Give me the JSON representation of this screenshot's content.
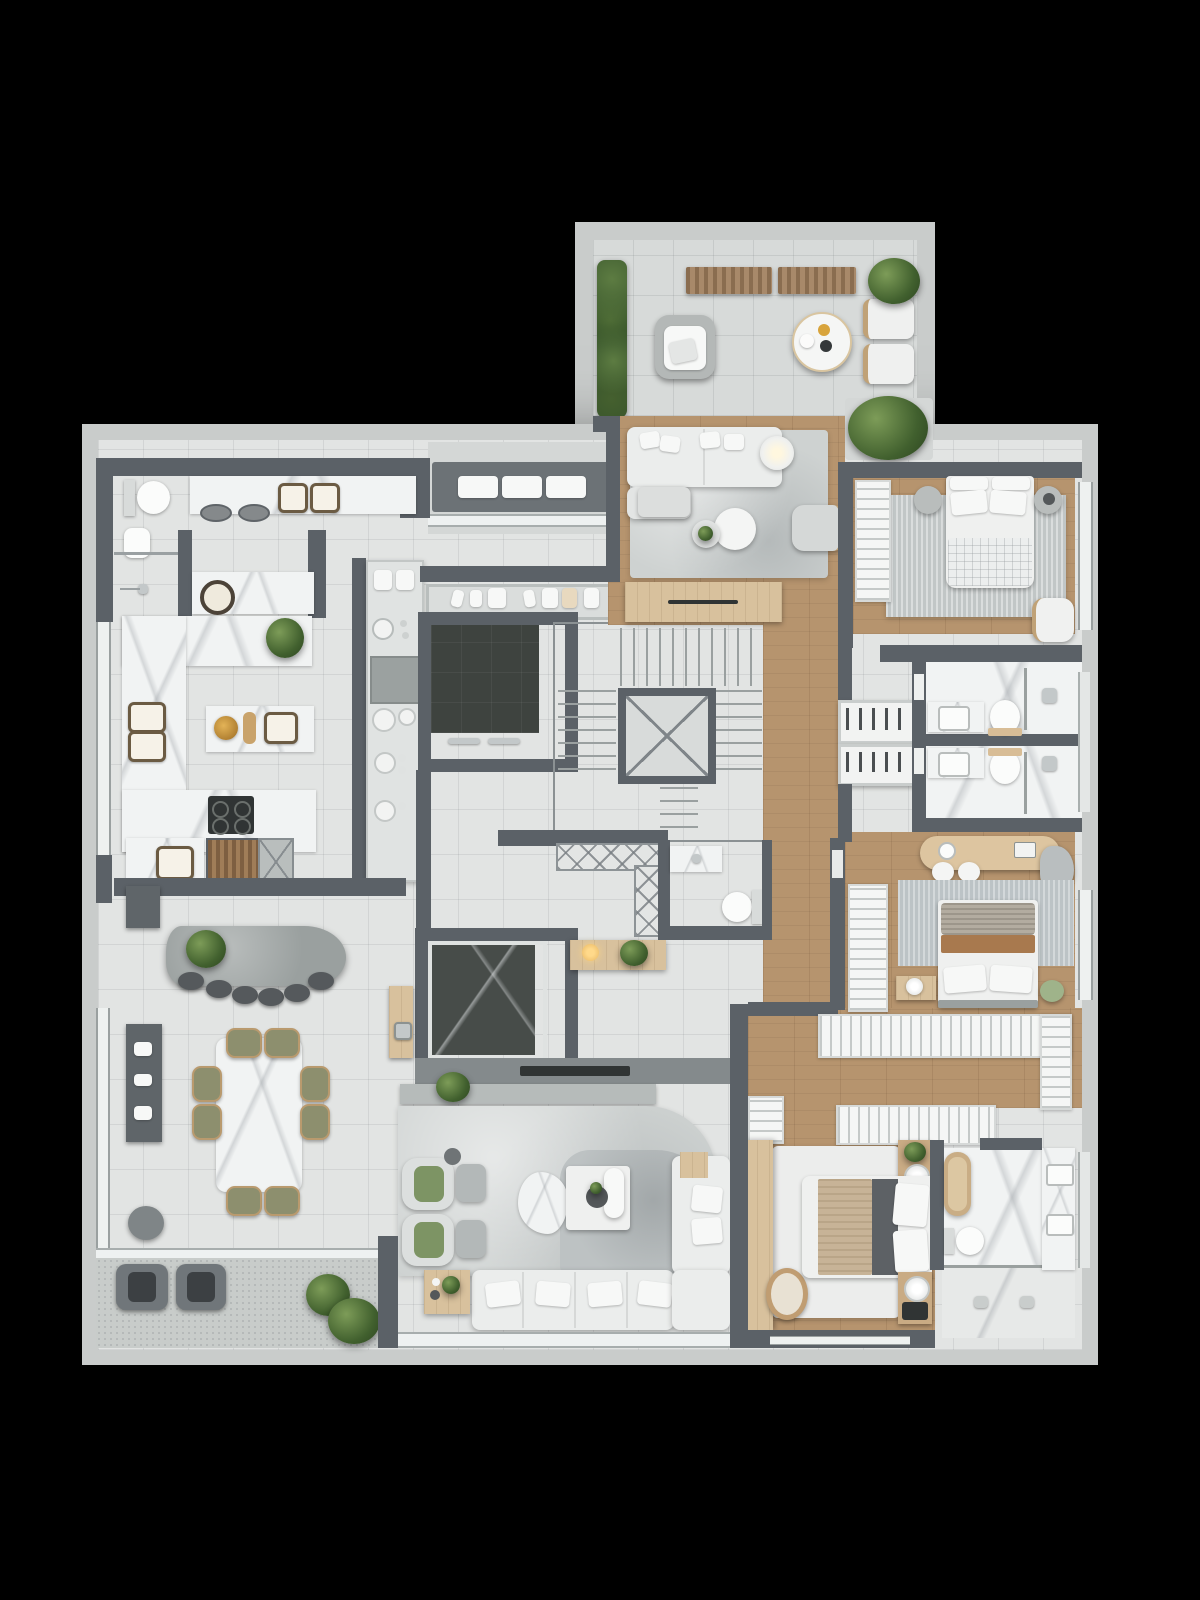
{
  "scene": {
    "type": "apartment-floor-plan-3d-render",
    "view": "top-down",
    "background": "#000000",
    "units_shown": "none",
    "text_visible": "none"
  },
  "palette": {
    "background": "#000000",
    "slab_concrete": "#c9cccb",
    "wall": "#5b6167",
    "tile_floor": "#e2e4e3",
    "terrace_tile": "#d7dad9",
    "balcony_speckle": "#c8ccca",
    "marble": "#f1f3f3",
    "wood_floor": "#b6946e",
    "wood_light": "#d8c19d",
    "dark_marble": "#474c49",
    "elevator_cab": "#3e433f",
    "rug_light": "#ced2d1",
    "rug_striped": "#c1c6c6",
    "sofa_white": "#ebedec",
    "plant_green": "#41602e",
    "olive_chair": "#8d8f6e",
    "brass": "#b99a6e",
    "dark_seat": "#55595c",
    "blanket_tan": "#c7b397",
    "blanket_brown": "#a8794e",
    "pouf_green": "#9fb38a"
  },
  "rooms": [
    {
      "id": "terrace",
      "furniture": [
        "hedge-planter",
        "slatted-bench",
        "slatted-bench",
        "outdoor-armchair",
        "round-table",
        "sun-lounger",
        "sun-lounger",
        "potted-plant",
        "shrub"
      ]
    },
    {
      "id": "upper-living-room",
      "furniture": [
        "sectional-sofa",
        "chaise-ottoman",
        "floor-lamp",
        "nesting-coffee-tables",
        "armchair",
        "area-rug",
        "media-sideboard"
      ]
    },
    {
      "id": "bedroom-suite-1",
      "furniture": [
        "double-bed",
        "nightstand",
        "nightstand",
        "open-wardrobe",
        "accent-chair",
        "striped-rug"
      ]
    },
    {
      "id": "service-bathroom",
      "furniture": [
        "toilet",
        "bidet",
        "shower"
      ]
    },
    {
      "id": "laundry",
      "furniture": [
        "sink-counter",
        "washer",
        "dryer",
        "utility-counter"
      ]
    },
    {
      "id": "kitchen",
      "furniture": [
        "u-counter",
        "double-sink",
        "island-with-sink",
        "gas-cooktop",
        "tall-cabinet-column",
        "plant"
      ]
    },
    {
      "id": "barbecue-corner",
      "furniture": [
        "grill",
        "prep-sink",
        "service-shaft"
      ]
    },
    {
      "id": "pantry-shelf",
      "furniture": [
        "dishware"
      ]
    },
    {
      "id": "service-elevator",
      "furniture": []
    },
    {
      "id": "staircase",
      "furniture": [
        "treads",
        "open-well"
      ]
    },
    {
      "id": "entry-hall",
      "furniture": [
        "private-elevator",
        "call-panel",
        "console-with-lamp",
        "lattice-screen"
      ]
    },
    {
      "id": "powder-room",
      "furniture": [
        "vanity",
        "toilet"
      ]
    },
    {
      "id": "hallway",
      "furniture": []
    },
    {
      "id": "shoe-closet",
      "furniture": [
        "shoe-shelf",
        "shoe-shelf"
      ]
    },
    {
      "id": "bathroom-1",
      "furniture": [
        "vanity-sink",
        "toilet",
        "walk-in-shower"
      ]
    },
    {
      "id": "bathroom-2",
      "furniture": [
        "vanity-sink",
        "toilet",
        "walk-in-shower"
      ]
    },
    {
      "id": "dressing-nook",
      "furniture": [
        "makeup-desk",
        "stool",
        "stool",
        "lounge-chair"
      ]
    },
    {
      "id": "bedroom-suite-2",
      "furniture": [
        "double-bed",
        "nightstand",
        "green-pouf",
        "open-wardrobe",
        "rug"
      ]
    },
    {
      "id": "walk-in-closet",
      "furniture": [
        "wardrobe-run",
        "wardrobe-run",
        "wardrobe-run",
        "wardrobe-run"
      ]
    },
    {
      "id": "bedroom-suite-3",
      "furniture": [
        "double-bed",
        "nightstand",
        "nightstand",
        "desk",
        "chair",
        "rug",
        "wardrobe"
      ]
    },
    {
      "id": "master-bathroom",
      "furniture": [
        "bathtub",
        "toilet",
        "double-vanity",
        "walk-in-shower"
      ]
    },
    {
      "id": "dining-area",
      "furniture": [
        "marble-dining-table",
        "dining-chairs-8",
        "gourmet-counter",
        "bar-stools-6",
        "bar-cabinet",
        "pouf"
      ]
    },
    {
      "id": "lower-living-room",
      "furniture": [
        "l-shaped-sectional",
        "swivel-armchair",
        "swivel-armchair",
        "ottoman",
        "ottoman",
        "marble-coffee-table",
        "side-table",
        "vase",
        "wood-side-table",
        "tv-console",
        "plant"
      ]
    },
    {
      "id": "lower-balcony",
      "furniture": [
        "outdoor-armchair",
        "outdoor-armchair",
        "plants"
      ]
    }
  ]
}
